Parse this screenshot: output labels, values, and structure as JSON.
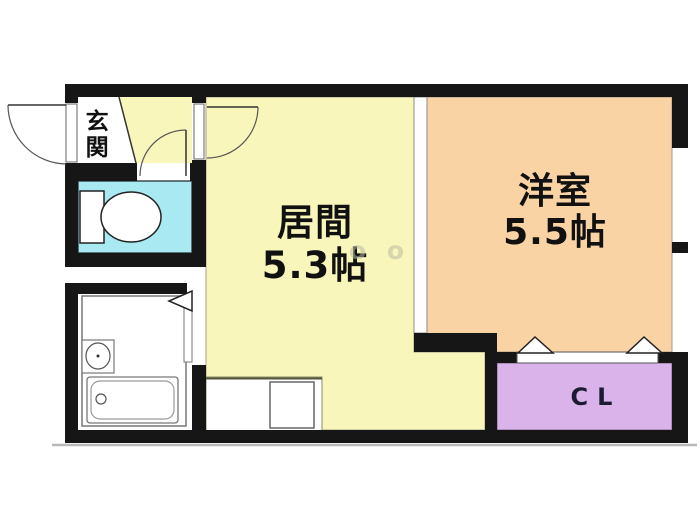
{
  "plan": {
    "type": "apartment-floor-plan",
    "background": "#ffffff",
    "wall_color": "#161616",
    "watermark": "o o",
    "rooms": [
      {
        "id": "genkan",
        "label": "玄関",
        "size": "",
        "color": "#ffffff"
      },
      {
        "id": "living",
        "label": "居間",
        "size": "5.3帖",
        "color": "#f9f6bc"
      },
      {
        "id": "western",
        "label": "洋室",
        "size": "5.5帖",
        "color": "#fad3a5"
      },
      {
        "id": "closet",
        "label": "CL",
        "size": "",
        "color": "#d9b3ea"
      },
      {
        "id": "toilet",
        "label": "",
        "size": "",
        "color": "#a9e9f2"
      },
      {
        "id": "bathroom",
        "label": "",
        "size": "",
        "color": "#ffffff"
      }
    ],
    "fixtures": [
      "toilet",
      "bathtub",
      "wash-basin",
      "kitchen-counter",
      "kitchen-sink"
    ],
    "doors": [
      "entrance-swing-door",
      "living-swing-door",
      "toilet-swing-door",
      "bathroom-folding-door",
      "closet-folding-door",
      "living-western-sliding-partition"
    ],
    "windows": [
      "right-wall-window-upper",
      "right-wall-window-lower"
    ]
  }
}
